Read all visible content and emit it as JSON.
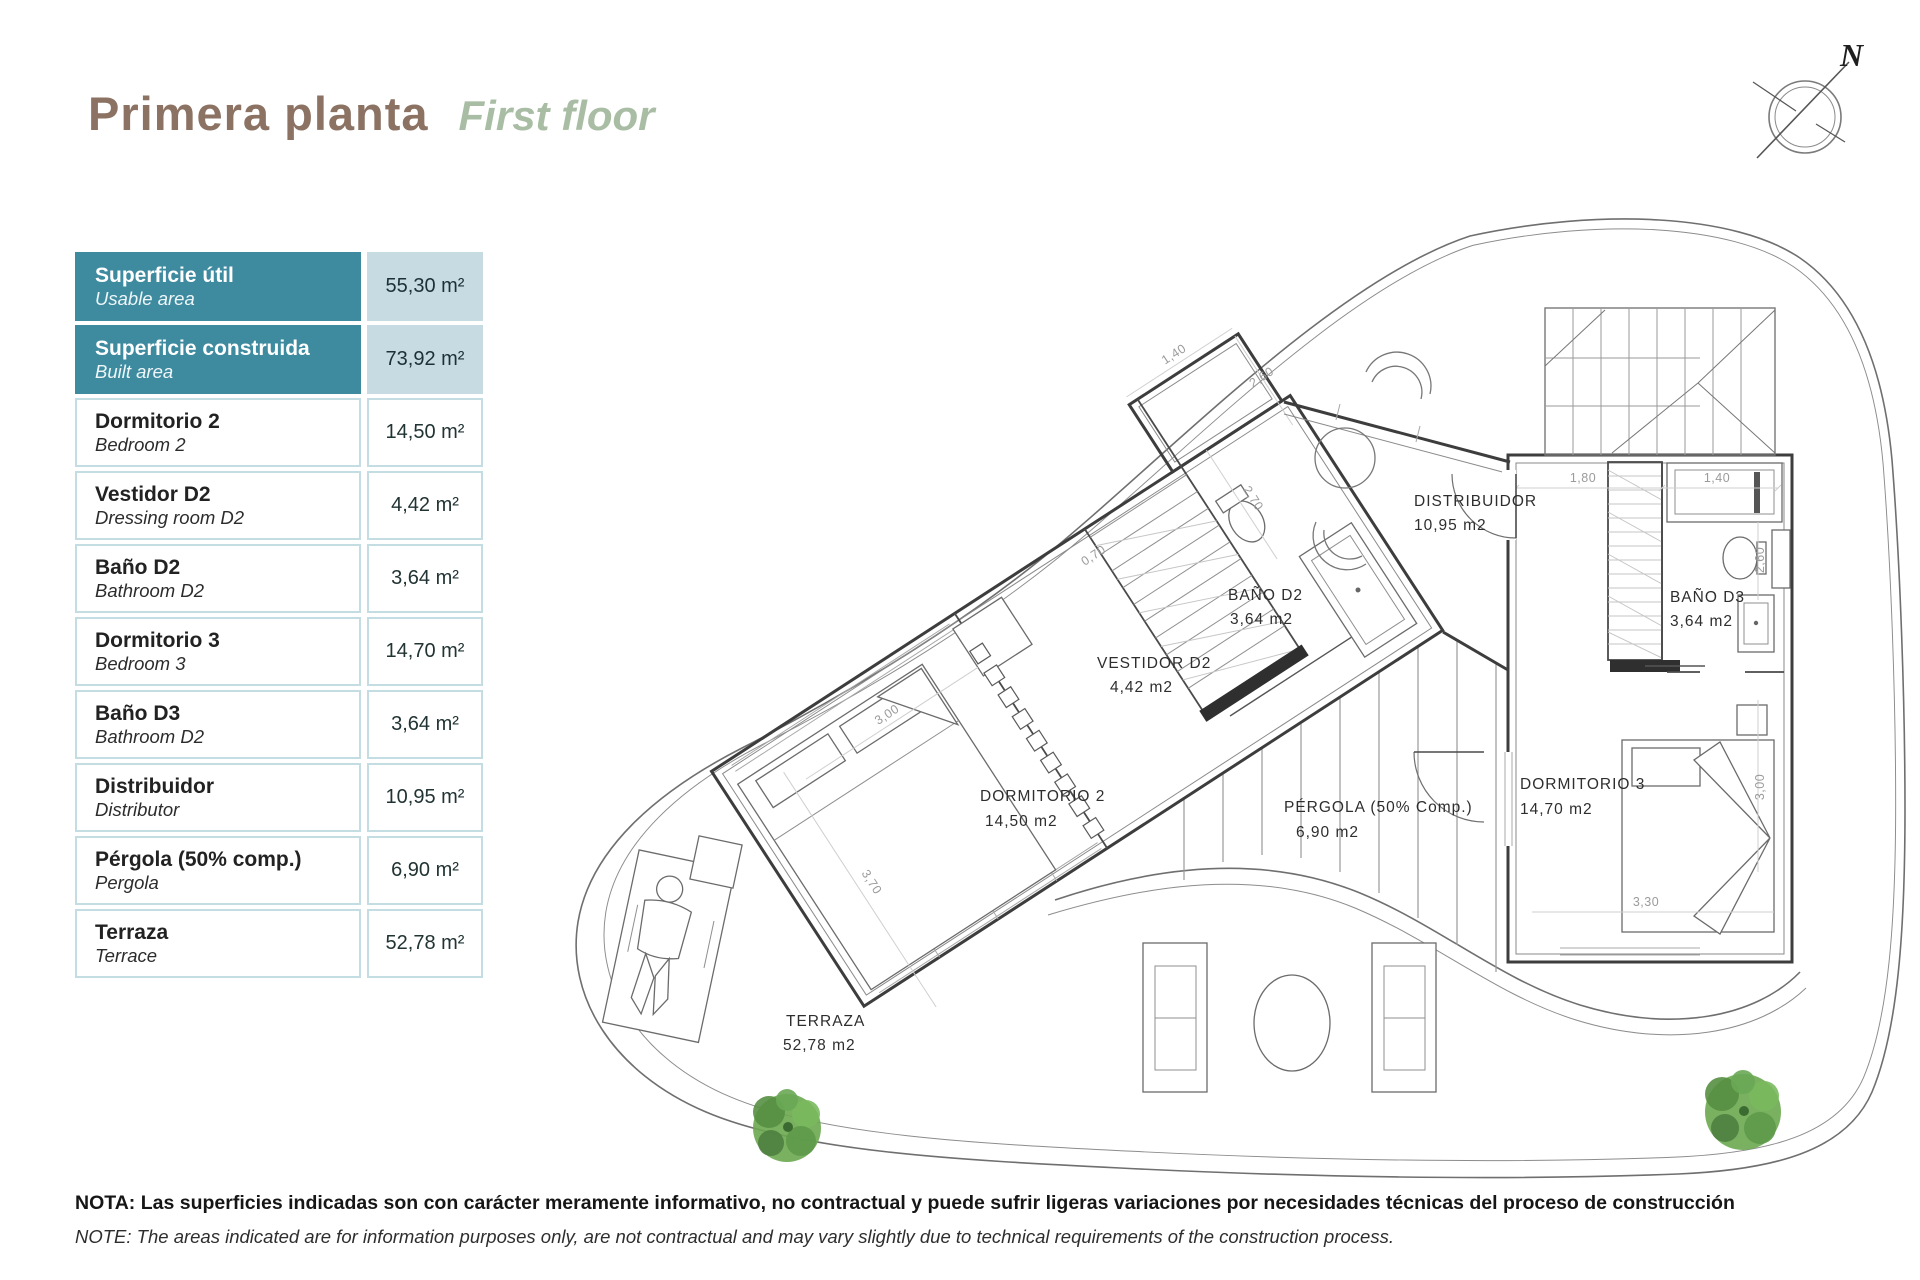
{
  "title": {
    "es": "Primera planta",
    "en": "First floor"
  },
  "compass": {
    "label": "N"
  },
  "area_table": {
    "rows": [
      {
        "es": "Superficie útil",
        "en": "Usable area",
        "value": "55,30 m²"
      },
      {
        "es": "Superficie construida",
        "en": "Built area",
        "value": "73,92 m²"
      },
      {
        "es": "Dormitorio 2",
        "en": "Bedroom 2",
        "value": "14,50 m²"
      },
      {
        "es": "Vestidor D2",
        "en": "Dressing room D2",
        "value": "4,42 m²"
      },
      {
        "es": "Baño D2",
        "en": "Bathroom D2",
        "value": "3,64 m²"
      },
      {
        "es": "Dormitorio 3",
        "en": "Bedroom 3",
        "value": "14,70 m²"
      },
      {
        "es": "Baño D3",
        "en": "Bathroom D2",
        "value": "3,64 m²"
      },
      {
        "es": "Distribuidor",
        "en": "Distributor",
        "value": "10,95 m²"
      },
      {
        "es": "Pérgola (50% comp.)",
        "en": "Pergola",
        "value": "6,90 m²"
      },
      {
        "es": "Terraza",
        "en": "Terrace",
        "value": "52,78 m²"
      }
    ]
  },
  "plan": {
    "rooms": [
      {
        "name": "DISTRIBUIDOR",
        "area": "10,95 m2"
      },
      {
        "name": "BAÑO D2",
        "area": "3,64 m2"
      },
      {
        "name": "VESTIDOR D2",
        "area": "4,42 m2"
      },
      {
        "name": "DORMITORIO 2",
        "area": "14,50 m2"
      },
      {
        "name": "PÉRGOLA (50% Comp.)",
        "area": "6,90 m2"
      },
      {
        "name": "BAÑO D3",
        "area": "3,64 m2"
      },
      {
        "name": "DORMITORIO 3",
        "area": "14,70 m2"
      },
      {
        "name": "TERRAZA",
        "area": "52,78 m2"
      }
    ],
    "dims": [
      "1,40",
      "2,60",
      "0,70",
      "3,00",
      "3,70",
      "2,70",
      "1,80",
      "1,40",
      "2,60",
      "3,00",
      "3,30"
    ]
  },
  "note": {
    "es": "NOTA: Las superficies indicadas son con carácter meramente informativo, no contractual y puede sufrir ligeras variaciones por necesidades técnicas del proceso de construcción",
    "en": "NOTE: The areas indicated are for information purposes only, are not contractual and may vary slightly due to technical requirements of the construction process."
  },
  "colors": {
    "header_teal": "#3e8ba0",
    "header_value_bg": "#c7dbe2",
    "cell_border": "#c3dde2",
    "title_brown": "#8b7263",
    "title_green": "#a9bda4",
    "plant_green": "#6aa84f"
  }
}
